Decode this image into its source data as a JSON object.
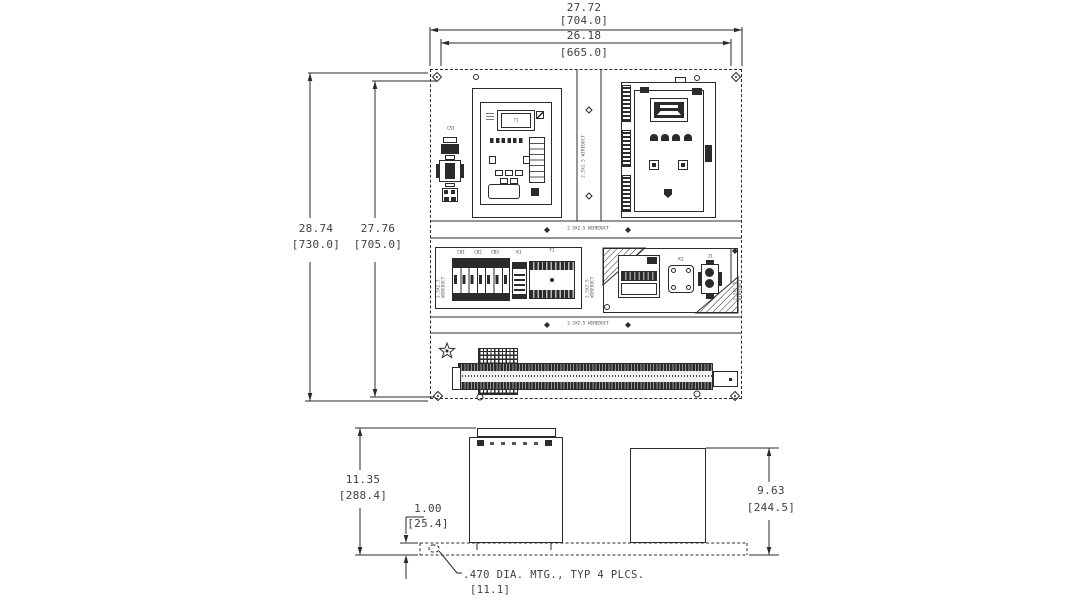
{
  "front_view": {
    "dim_overall_width_in": "27.72",
    "dim_overall_width_mm": "[704.0]",
    "dim_mount_width_in": "26.18",
    "dim_mount_width_mm": "[665.0]",
    "dim_overall_height_in": "28.74",
    "dim_overall_height_mm": "[730.0]",
    "dim_mount_height_in": "27.76",
    "dim_mount_height_mm": "[705.0]",
    "wireduct_label": "2.5X2.5 WIREDUCT",
    "components": {
      "control_switch": "CS1",
      "breaker_1": "CB1",
      "breaker_2": "CB2",
      "breaker_3": "CB3",
      "relay_k1": "K1",
      "fuse_block": "F1",
      "relay_k2": "K2",
      "receptacle": "J1",
      "relay_display": "71"
    }
  },
  "side_view": {
    "dim_depth_left_in": "11.35",
    "dim_depth_left_mm": "[288.4]",
    "dim_base_in": "1.00",
    "dim_base_mm": "[25.4]",
    "dim_depth_right_in": "9.63",
    "dim_depth_right_mm": "[244.5]"
  },
  "notes": {
    "mounting_note": ".470 DIA. MTG., TYP 4 PLCS.",
    "mounting_note_mm": "[11.1]"
  },
  "colors": {
    "line": "#2b2b2b",
    "background": "#ffffff"
  }
}
